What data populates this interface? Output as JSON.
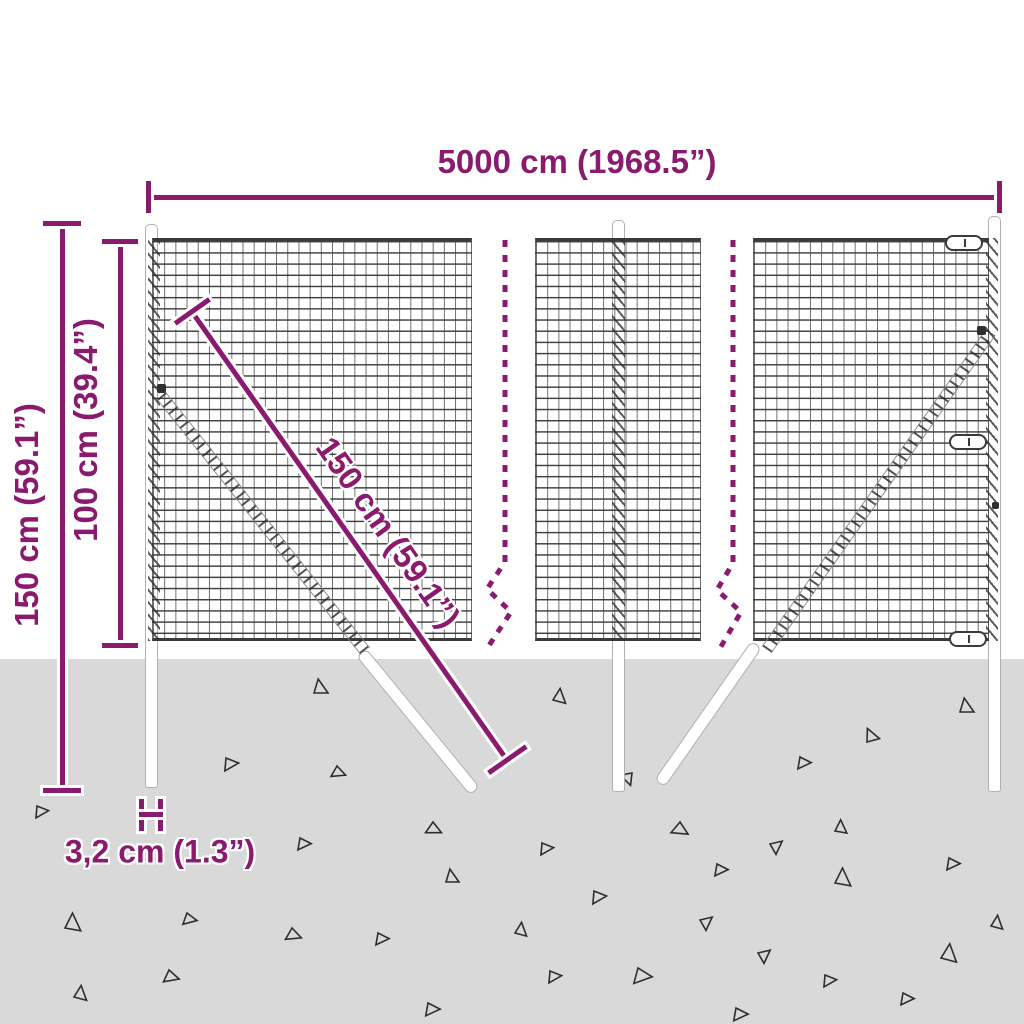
{
  "diagram": {
    "description": "wire-mesh-fence-dimension-diagram",
    "labels": {
      "total_width": "5000 cm (1968.5”)",
      "overall_height": "150 cm (59.1”)",
      "above_ground_height": "100 cm (39.4”)",
      "brace_length": "150 cm (59.1”)",
      "post_width": "3,2 cm (1.3”)"
    },
    "colors": {
      "accent": "#8a1a6e",
      "ground": "#d9d9d9",
      "mesh_line": "#3a3a3a",
      "post_outline": "#b0b0b0",
      "triangle": "#2e2e2e",
      "background": "#ffffff"
    },
    "decor": {
      "triangles": [
        [
          314,
          693,
          14,
          0
        ],
        [
          553,
          700,
          13,
          15
        ],
        [
          960,
          712,
          14,
          0
        ],
        [
          867,
          742,
          13,
          -15
        ],
        [
          800,
          757,
          12,
          100
        ],
        [
          632,
          773,
          12,
          170
        ],
        [
          226,
          758,
          13,
          95
        ],
        [
          337,
          766,
          12,
          120
        ],
        [
          37,
          806,
          12,
          95
        ],
        [
          433,
          822,
          13,
          125
        ],
        [
          300,
          838,
          12,
          100
        ],
        [
          446,
          882,
          13,
          0
        ],
        [
          65,
          928,
          16,
          10
        ],
        [
          187,
          913,
          12,
          110
        ],
        [
          292,
          928,
          13,
          120
        ],
        [
          378,
          933,
          12,
          100
        ],
        [
          169,
          970,
          13,
          115
        ],
        [
          74,
          997,
          13,
          15
        ],
        [
          428,
          1003,
          13,
          100
        ],
        [
          542,
          843,
          12,
          95
        ],
        [
          680,
          822,
          14,
          130
        ],
        [
          770,
          844,
          12,
          60
        ],
        [
          835,
          831,
          12,
          10
        ],
        [
          717,
          864,
          12,
          100
        ],
        [
          949,
          858,
          12,
          100
        ],
        [
          594,
          891,
          13,
          95
        ],
        [
          835,
          883,
          16,
          10
        ],
        [
          700,
          920,
          12,
          60
        ],
        [
          515,
          933,
          12,
          15
        ],
        [
          991,
          926,
          12,
          15
        ],
        [
          758,
          953,
          12,
          60
        ],
        [
          550,
          971,
          12,
          95
        ],
        [
          638,
          968,
          16,
          105
        ],
        [
          825,
          975,
          12,
          95
        ],
        [
          941,
          958,
          16,
          15
        ],
        [
          903,
          993,
          12,
          100
        ],
        [
          736,
          1008,
          13,
          100
        ]
      ]
    }
  }
}
